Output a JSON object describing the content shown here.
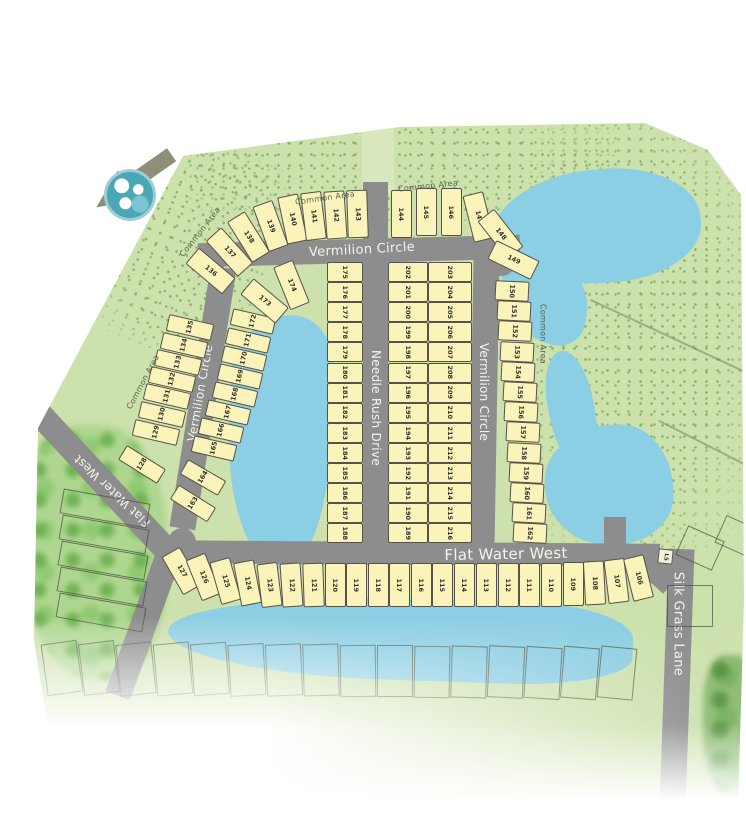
{
  "map_title": "Residential subdivision site plan",
  "streets": {
    "vermilion_top": "Vermilion Circle",
    "vermilion_left": "Vermilion Circle",
    "vermilion_right": "Vermilion Circle",
    "needle_rush": "Needle Rush Drive",
    "flat_water_horizontal": "Flat Water West",
    "flat_water_diagonal": "Flat Water West",
    "silk_grass": "Silk Grass Lane"
  },
  "common_area": {
    "label": "Common Area"
  },
  "special": {
    "lift_station": "L5"
  },
  "lot_groups": {
    "top_arc_west": [
      136,
      137,
      138,
      139,
      140,
      141,
      142,
      143
    ],
    "top_arc_east": [
      144,
      145,
      146,
      147,
      148,
      149
    ],
    "outer_east_col": [
      150,
      151,
      152,
      153,
      154,
      155,
      156,
      157,
      158,
      159,
      160,
      161,
      162
    ],
    "west_diag_col": [
      135,
      134,
      133,
      132,
      131,
      130,
      129,
      128
    ],
    "east_diag_col": [
      172,
      171,
      170,
      169,
      168,
      167,
      166,
      165,
      164,
      163
    ],
    "inner_corner": [
      173,
      174
    ],
    "needle_west_col": [
      175,
      176,
      177,
      178,
      179,
      180,
      181,
      182,
      183,
      184,
      185,
      186,
      187,
      188
    ],
    "needle_east_col": [
      202,
      201,
      200,
      199,
      198,
      197,
      196,
      195,
      194,
      193,
      192,
      191,
      190,
      189
    ],
    "vermilion_inner_col": [
      203,
      204,
      205,
      206,
      207,
      208,
      209,
      210,
      211,
      212,
      213,
      214,
      215,
      216
    ],
    "south_row": [
      127,
      126,
      125,
      124,
      123,
      122,
      121,
      120,
      119,
      118,
      117,
      116,
      115,
      114,
      113,
      112,
      111,
      110,
      109,
      108,
      107,
      106
    ]
  },
  "colors": {
    "base_green": "#cde1ad",
    "pond_blue": "#8ccee3",
    "road_gray": "#8d8d8d",
    "lot_fill": "#faf3ba",
    "lot_outline": "#55524a"
  }
}
